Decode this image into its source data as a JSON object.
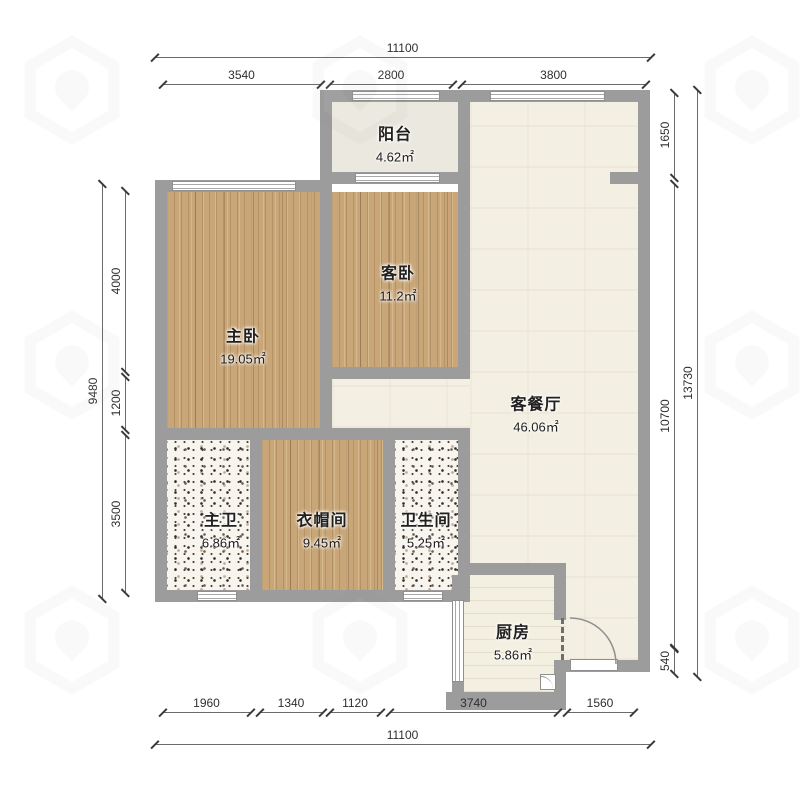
{
  "rooms": {
    "balcony": {
      "name": "阳台",
      "area": "4.62㎡"
    },
    "guest_bedroom": {
      "name": "客卧",
      "area": "11.2㎡"
    },
    "master_bedroom": {
      "name": "主卧",
      "area": "19.05㎡"
    },
    "living_dining": {
      "name": "客餐厅",
      "area": "46.06㎡"
    },
    "master_bath": {
      "name": "主卫",
      "area": "6.86㎡"
    },
    "cloakroom": {
      "name": "衣帽间",
      "area": "9.45㎡"
    },
    "bathroom": {
      "name": "卫生间",
      "area": "5.25㎡"
    },
    "kitchen": {
      "name": "厨房",
      "area": "5.86㎡"
    }
  },
  "dims": {
    "top_total": "11100",
    "top_segs": [
      "3540",
      "2800",
      "3800"
    ],
    "bottom_total": "11100",
    "bottom_segs": [
      "1960",
      "1340",
      "1120",
      "3740",
      "1560"
    ],
    "left_total": "9480",
    "left_segs": [
      "4000",
      "1200",
      "3500"
    ],
    "right_total": "13730",
    "right_segs": [
      "1650",
      "10700",
      "540"
    ]
  },
  "colors": {
    "wall": "#9c9c9c",
    "wood_floor": "#c9a678",
    "living_floor": "#f3efe2",
    "terrazzo_floor": "#f8f5ef",
    "kitchen_floor": "#f4f0e1",
    "balcony_floor": "#ebe8df"
  }
}
